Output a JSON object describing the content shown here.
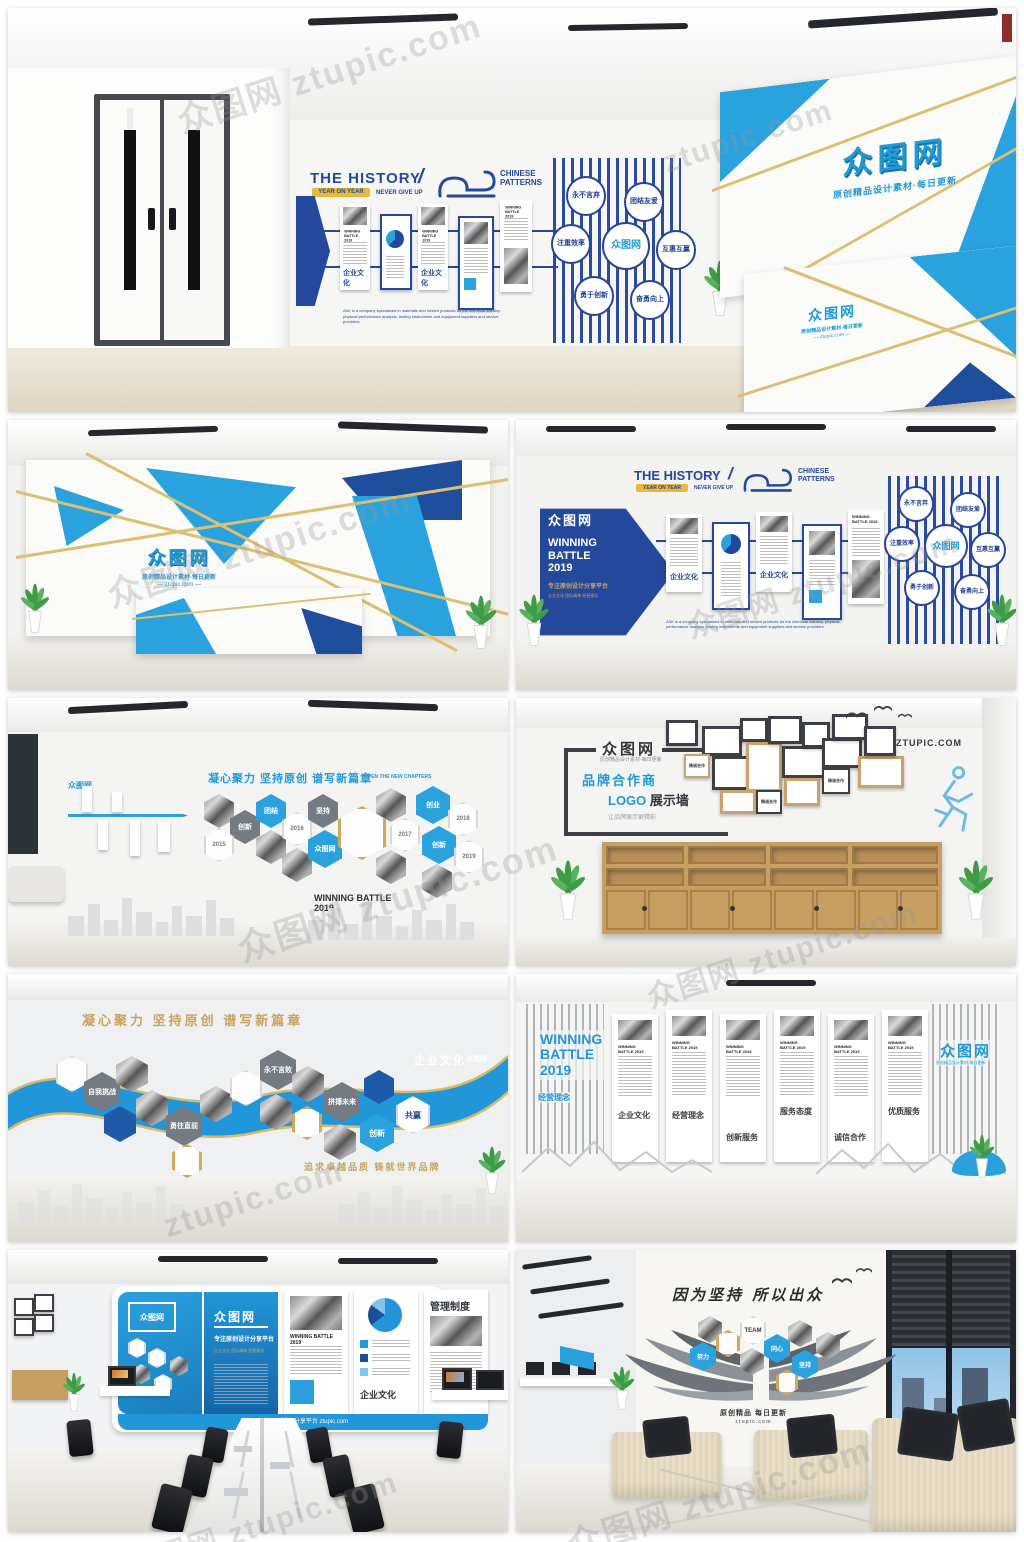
{
  "watermark": {
    "combo": "众图网 ztupic.com",
    "url": "ztupic.com"
  },
  "brand": {
    "logo": "众图网",
    "tagline": "原创精品设计素材·每日更新",
    "url": "ztupic.com",
    "url_upper": "ZTUPIC.COM",
    "url_dashed": "— ztupic.com —"
  },
  "shared": {
    "history_title": "THE HISTORY",
    "slash": "/",
    "gold_tag": "YEAR ON YEAR",
    "never_give_up": "NEVER GIVE UP",
    "patterns1": "CHINESE",
    "patterns2": "PATTERNS",
    "winning1": "WINNING",
    "winning2": "BATTLE",
    "winning3": "2019",
    "winning_inline": "WINNING BATTLE 2019",
    "corp_culture": "企业文化",
    "platform": "专注原创设计分享平台",
    "desc_en": "ZAK is a company specialized in materials and related products for the chemical industry, physical performance analysis, testing instruments and equipment suppliers and service providers.",
    "circles": [
      "永不言弃",
      "团结友爱",
      "注重效率",
      "互惠互赢",
      "勇于创新",
      "奋勇向上"
    ]
  },
  "tile2r": {
    "tags": [
      "企业文化",
      "团队精神",
      "经营理念"
    ]
  },
  "tile3l": {
    "title": "凝心聚力 坚持原创 谱写新篇章",
    "subtitle_en": "OPEN THE NEW CHAPTERS",
    "years": [
      "2015",
      "2016",
      "2017",
      "2018",
      "2019"
    ],
    "words": [
      "创新",
      "团结",
      "坚持",
      "创业"
    ],
    "insist": "INSIST"
  },
  "tile3r": {
    "brand_title": "品牌合作商",
    "brand_sub_blue": "LOGO",
    "brand_sub_dark": "展示墙",
    "caption": "让品牌展示更精彩",
    "frame_label": "精诚合作"
  },
  "tile4l": {
    "title": "凝心聚力 坚持原创 谱写新篇章",
    "slogan": "追求卓越品质 铸就世界品牌",
    "hex_words": [
      "自我挑战",
      "勇往直前",
      "永不言败",
      "拼搏未来",
      "创新",
      "共赢"
    ]
  },
  "tile4r": {
    "left_sub": "经营理念",
    "panel_subs": [
      "企业文化",
      "经营理念",
      "创新服务",
      "服务态度",
      "诚信合作",
      "优质服务"
    ]
  },
  "tile5l": {
    "mgmt": "管理制度"
  },
  "tile5r": {
    "title": "因为坚持 所以出众",
    "team": "TEAM",
    "caption": "原创精品 每日更新",
    "hex_words": [
      "努力",
      "同心",
      "坚持"
    ]
  }
}
